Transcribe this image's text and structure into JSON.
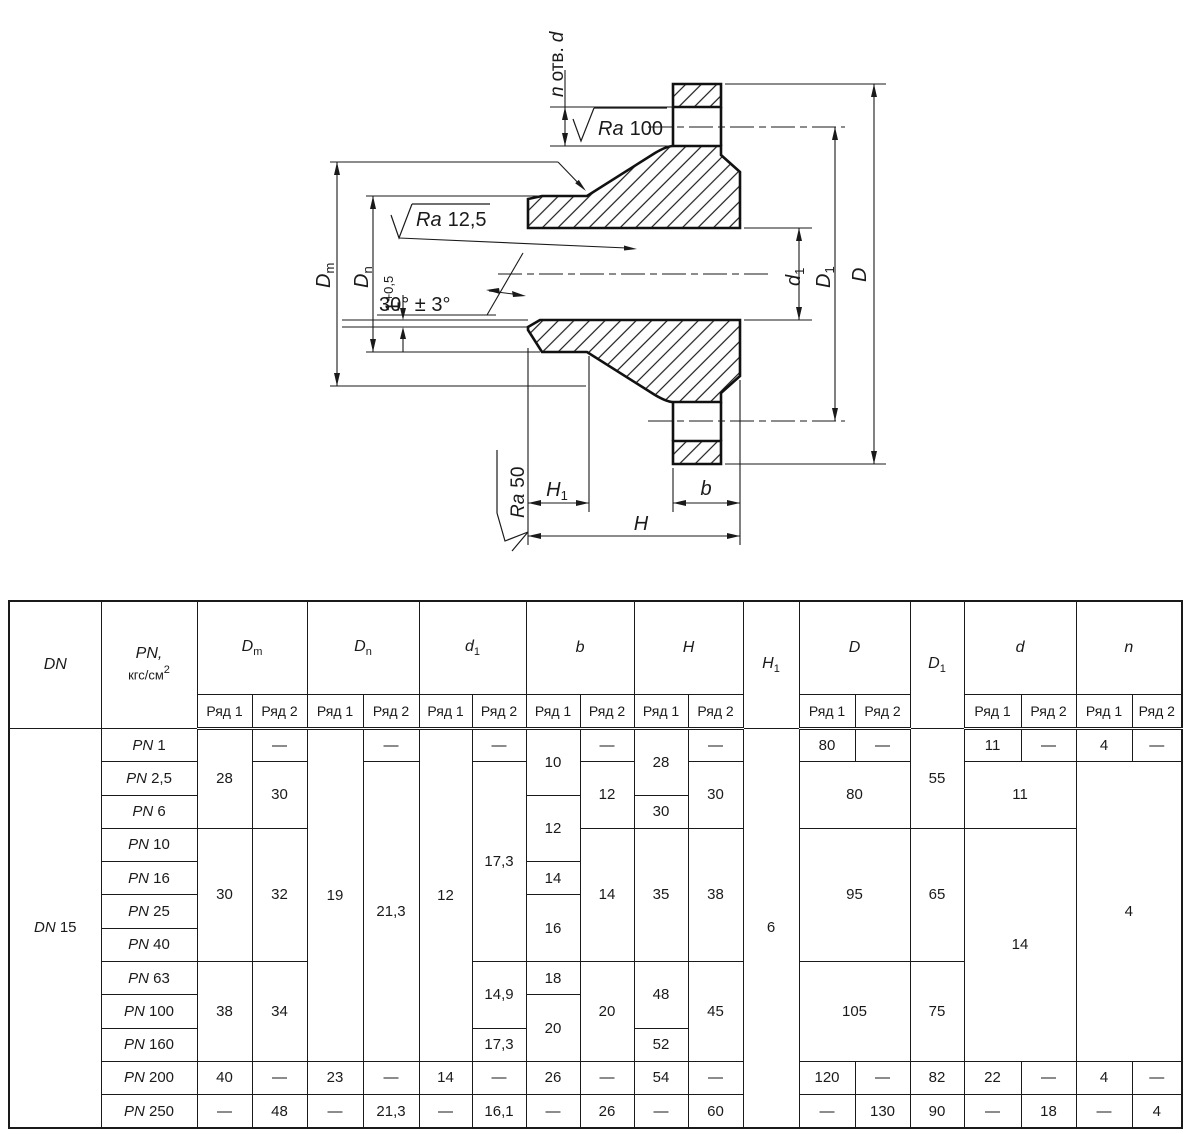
{
  "colors": {
    "ink": "#1a1a1a",
    "background": "#ffffff"
  },
  "drawing": {
    "n_holes_n": "n",
    "n_holes_text": "отв.",
    "n_holes_d": "d",
    "ra_prefix": "Ra",
    "ra100_value": "100",
    "ra125_value": "12,5",
    "ra50_value": "50",
    "chamfer_base": "1",
    "chamfer_tol": "+0,5",
    "angle": "30° ± 3°",
    "dim_dm_main": "D",
    "dim_dm_sub": "m",
    "dim_dn_main": "D",
    "dim_dn_sub": "n",
    "dim_d1_main": "d",
    "dim_d1_sub": "1",
    "dim_D1_main": "D",
    "dim_D1_sub": "1",
    "dim_D": "D",
    "dim_H1_main": "H",
    "dim_H1_sub": "1",
    "dim_H": "H",
    "dim_b": "b"
  },
  "table": {
    "header": {
      "dn": "DN",
      "pn_main": "PN,",
      "pn_unit": "кгс/см",
      "pn_exp": "2",
      "ryad1": "Ряд 1",
      "ryad2": "Ряд 2",
      "dm_main": "D",
      "dm_sub": "m",
      "dn_main": "D",
      "dn_sub": "n",
      "d1_main": "d",
      "d1_sub": "1",
      "b": "b",
      "h": "H",
      "h1_main": "H",
      "h1_sub": "1",
      "D": "D",
      "D1_main": "D",
      "D1_sub": "1",
      "d": "d",
      "n": "n"
    },
    "body": {
      "dn_label": "DN",
      "dn_value": "15",
      "pn_label": "PN",
      "pn": [
        "1",
        "2,5",
        "6",
        "10",
        "16",
        "25",
        "40",
        "63",
        "100",
        "160",
        "200",
        "250"
      ],
      "dm1": [
        "28",
        "30",
        "38",
        "40",
        "—"
      ],
      "dm2": [
        "—",
        "30",
        "32",
        "34",
        "—",
        "48"
      ],
      "dn1": [
        "19",
        "23",
        "—"
      ],
      "dn2": [
        "—",
        "21,3",
        "—",
        "21,3"
      ],
      "d11": [
        "12",
        "14",
        "—"
      ],
      "d12": [
        "—",
        "17,3",
        "14,9",
        "17,3",
        "—",
        "16,1"
      ],
      "b1": [
        "10",
        "12",
        "14",
        "16",
        "18",
        "20",
        "26",
        "—"
      ],
      "b2": [
        "—",
        "12",
        "14",
        "20",
        "—",
        "26"
      ],
      "h1": [
        "28",
        "30",
        "35",
        "48",
        "52",
        "54",
        "—"
      ],
      "h2": [
        "—",
        "30",
        "38",
        "45",
        "—",
        "60"
      ],
      "h1_span": "6",
      "D_r1": [
        "80",
        "—"
      ],
      "D_merged": [
        "80",
        "95",
        "105"
      ],
      "D_r11": [
        "120",
        "—"
      ],
      "D_r12": [
        "—",
        "130"
      ],
      "D1": [
        "55",
        "65",
        "75",
        "82",
        "90"
      ],
      "d_r1": [
        "11",
        "—"
      ],
      "d_merged": [
        "11",
        "14"
      ],
      "d_r11": [
        "22",
        "—"
      ],
      "d_r12": [
        "—",
        "18"
      ],
      "n_r1": [
        "4",
        "—"
      ],
      "n_merged": "4",
      "n_r11": [
        "4",
        "—"
      ],
      "n_r12": [
        "—",
        "4"
      ]
    }
  }
}
